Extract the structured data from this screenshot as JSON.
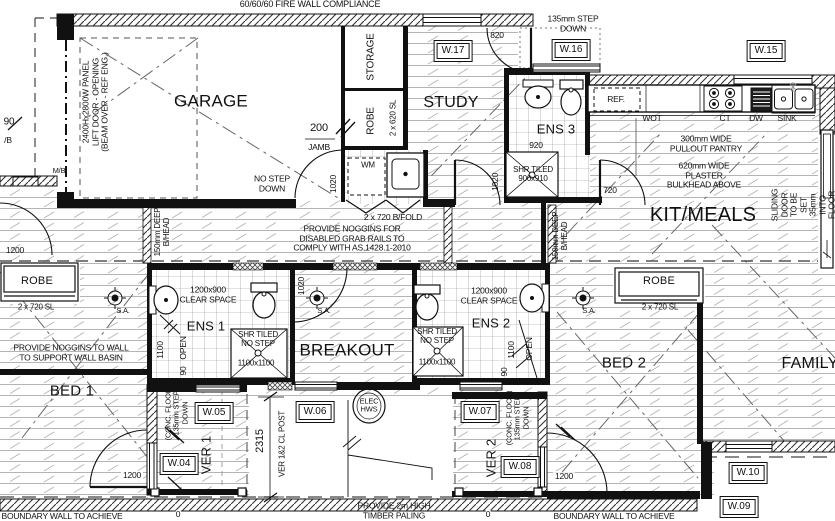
{
  "plan": {
    "notes": {
      "fire_wall": "60/60/60 FIRE WALL COMPLIANCE",
      "step_down_porch": "135mm STEP\nDOWN",
      "garage_door": "2400Hx2800W PANEL\nLIFT DOOR - OPENING\n(BEAM OVER - REF ENG.)",
      "no_step": "NO STEP\nDOWN",
      "jamb": "JAMB",
      "noggins_disabled": "PROVIDE NOGGINS FOR\nDISABLED GRAB RAILS TO\nCOMPLY WITH AS.1428.1-2010",
      "noggins_basin": "PROVIDE NOGGINS TO WALL\nTO SUPPORT WALL BASIN",
      "pantry": "300mm WIDE\nPULLOUT PANTRY",
      "bulkhead": "620mm WIDE\nPLASTER\nBULKHEAD ABOVE",
      "sliding": "SLIDING DOOR TO BE SET\n35mm INTO FLOOR",
      "bhead": "150mm DEEP\nB/HEAD",
      "shr_ens3": "SHR TILED\n900x910",
      "shr_no_step": "SHR TILED\nNO STEP",
      "shr_size": "1100x1100",
      "clear_space": "1200x900\nCLEAR SPACE",
      "conc_floor": "(CONC. FLOOR)\n135mm STEP\nDOWN",
      "ver_post": "VER 1&2 CL POST",
      "timber": "PROVIDE 2m HIGH\nTIMBER PALING",
      "boundary": "BOUNDARY WALL TO ACHIEVE"
    },
    "rooms": {
      "garage": "GARAGE",
      "study": "STUDY",
      "storage": "STORAGE",
      "robe": "ROBE",
      "ens1": "ENS 1",
      "ens2": "ENS 2",
      "ens3": "ENS 3",
      "kit": "KIT/MEALS",
      "breakout": "BREAKOUT",
      "bed1": "BED 1",
      "bed2": "BED 2",
      "family": "FAMILY",
      "ver1": "VER 1",
      "ver2": "VER 2"
    },
    "windows": {
      "w04": "W.04",
      "w05": "W.05",
      "w06": "W.06",
      "w07": "W.07",
      "w08": "W.08",
      "w09": "W.09",
      "w10": "W.10",
      "w15": "W.15",
      "w16": "W.16",
      "w17": "W.17"
    },
    "dims": {
      "d820": "820",
      "d920": "920",
      "d720": "720",
      "d200": "200",
      "d1020": "1020",
      "d1100": "1100",
      "d90": "90",
      "open": "OPEN",
      "d1200": "1200",
      "d2315": "2315",
      "sl720": "2 x 720 SL",
      "sl620": "2 x 620 SL",
      "bifold": "2 x 720 B/FOLD",
      "frag90": "90",
      "fragB": "/B",
      "frag0": "0"
    },
    "fixtures": {
      "ref": "REF.",
      "wot": "WOT",
      "ct": "CT",
      "dw": "DW",
      "sink": "SINK",
      "wm": "WM",
      "hws": "ELEC\nHWS",
      "sa": "S.A.",
      "mb": "M/B"
    }
  }
}
